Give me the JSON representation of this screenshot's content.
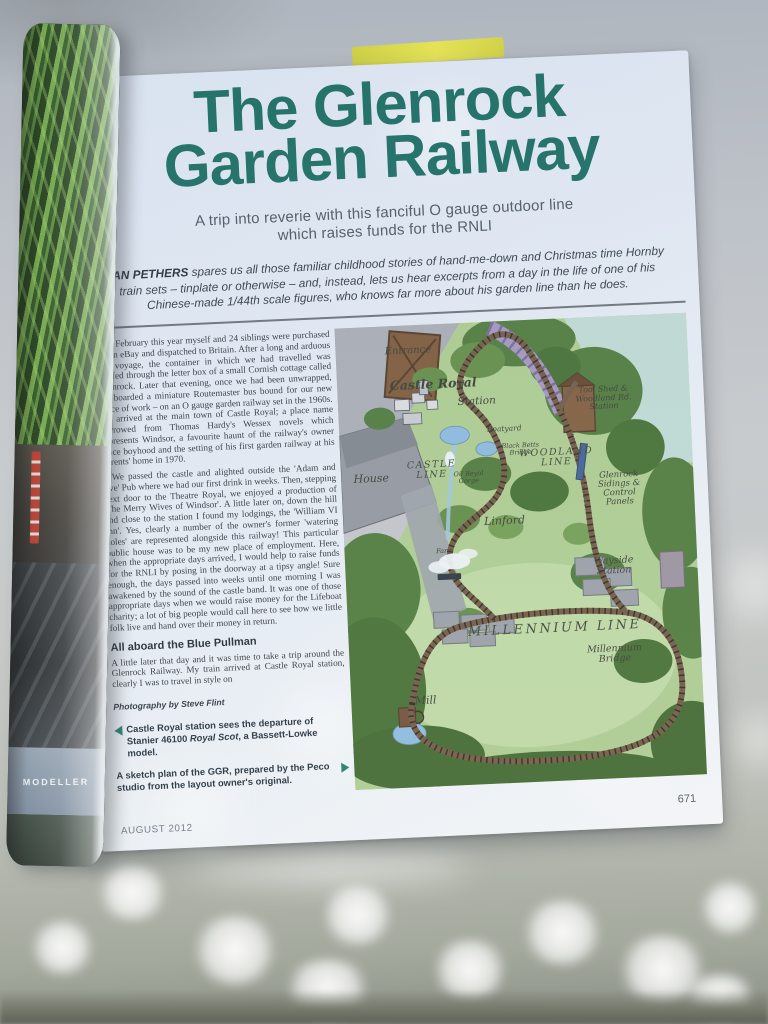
{
  "magazine": {
    "spine_text": "MODELLER"
  },
  "article": {
    "title_line1": "The Glenrock",
    "title_line2": "Garden Railway",
    "standfirst_line1": "A trip into reverie with this fanciful O gauge outdoor line",
    "standfirst_line2": "which raises funds for the RNLI",
    "intro": {
      "author": "IAN PETHERS",
      "text": " spares us all those familiar childhood stories of hand-me-down and Christmas time Hornby train sets – tinplate or otherwise – and, instead, lets us hear excerpts from a day in the life of one of his Chinese-made 1/44th scale figures, who knows far more about his garden line than he does."
    },
    "body": {
      "dropcap": "I",
      "paragraph1": "n February this year myself and 24 siblings were purchased on eBay and dispatched to Britain. After a long and arduous sea voyage, the container in which we had travelled was stuffed through the letter box of a small Cornish cottage called Glenrock. Later that evening, once we had been unwrapped, we boarded a miniature Routemaster bus bound for our new place of work – on an O gauge garden railway set in the 1960s. We arrived at the main town of Castle Royal; a place name borrowed from Thomas Hardy's Wessex novels which represents Windsor, a favourite haunt of the railway's owner since boyhood and the setting of his first garden railway at his parents' home in 1970.",
      "paragraph2": "We passed the castle and alighted outside the 'Adam and Eve' Pub where we had our first drink in weeks. Then, stepping next door to the Theatre Royal, we enjoyed a production of 'The Merry Wives of Windsor'. A little later on, down the hill and close to the station I found my lodgings, the 'William VI Inn'. Yes, clearly a number of the owner's former 'watering holes' are represented alongside this railway! This particular public house was to be my new place of employment. Here, when the appropriate days arrived, I would help to raise funds for the RNLI by posing in the doorway at a tipsy angle! Sure enough, the days passed into weeks until one morning I was awakened by the sound of the castle band. It was one of those appropriate days when we would raise money for the Lifeboat charity; a lot of big people would call here to see how we little folk live and hand over their money in return.",
      "subheading": "All aboard the Blue Pullman",
      "paragraph3": "A little later that day and it was time to take a trip around the Glenrock Railway. My train arrived at Castle Royal station, clearly I was to travel in style on"
    },
    "photo_credit": "Photography by Steve Flint",
    "captions": {
      "caption1_part1": "Castle Royal station sees the departure of Stanier 46100 ",
      "caption1_italic": "Royal Scot",
      "caption1_part2": ", a Bassett-Lowke model.",
      "caption2": "A sketch plan of the GGR, prepared by the Peco studio from the layout owner's original."
    },
    "footer": {
      "issue_date": "AUGUST 2012",
      "page_number": "671"
    }
  },
  "map": {
    "labels": {
      "entrance": "Entrance",
      "castle_royal": "Castle Royal",
      "station": "Station",
      "boatyard": "Boatyard",
      "black_betts_bridge": "Black Betts Bridge",
      "house": "House",
      "castle_line": "CASTLE LINE",
      "gorge": "Oil Beyol Gorge",
      "woodland_line": "WOODLAND LINE",
      "tool_shed_station": "Tool Shed & Woodland Rd. Station",
      "glenrock_sidings": "Glenrock Sidings & Control Panels",
      "linford": "Linford",
      "farm": "Farm",
      "wayside_station": "Wayside Station",
      "millennium_line": "MILLENNIUM LINE",
      "millennium_bridge": "Millennium Bridge",
      "mill": "Mill"
    }
  },
  "colors": {
    "title_teal": "#14695e",
    "caption_arrow_teal": "#1b7a6c",
    "page_background": "#e3eaf3",
    "map_grass": "#abcb8e",
    "yellow_page_edge": "#e2df3e",
    "dropcap_green": "#1b7a5e"
  }
}
